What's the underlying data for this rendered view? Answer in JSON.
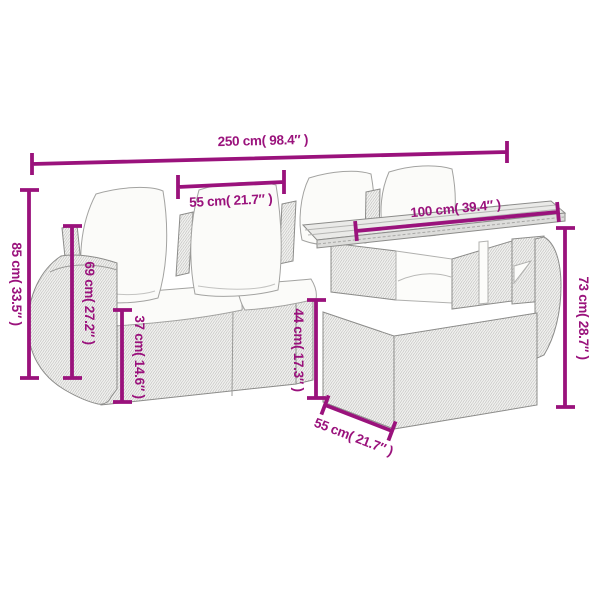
{
  "diagram": {
    "title": "furniture-dimension-diagram",
    "colors": {
      "dimension_accent": "#9A127C",
      "outline_gray": "#8C8C8A",
      "weave_hatch": "#BCBCBA",
      "rattan_fill": "#F1F1EF",
      "cushion_fill": "#FBFBF9",
      "tabletop_fill": "#EAEAE8",
      "background": "#FFFFFF"
    },
    "labels": {
      "overall_width": "250 cm( 98.4″ )",
      "seat_width": "55 cm( 21.7″ )",
      "table_width": "100 cm( 39.4″ )",
      "overall_height": "85 cm( 33.5″ )",
      "back_height": "69 cm( 27.2″ )",
      "seat_height": "37 cm( 14.6″ )",
      "side_height": "44 cm( 17.3″ )",
      "table_height": "73 cm( 28.7″ )",
      "table_depth": "55 cm( 21.7″ )"
    }
  }
}
